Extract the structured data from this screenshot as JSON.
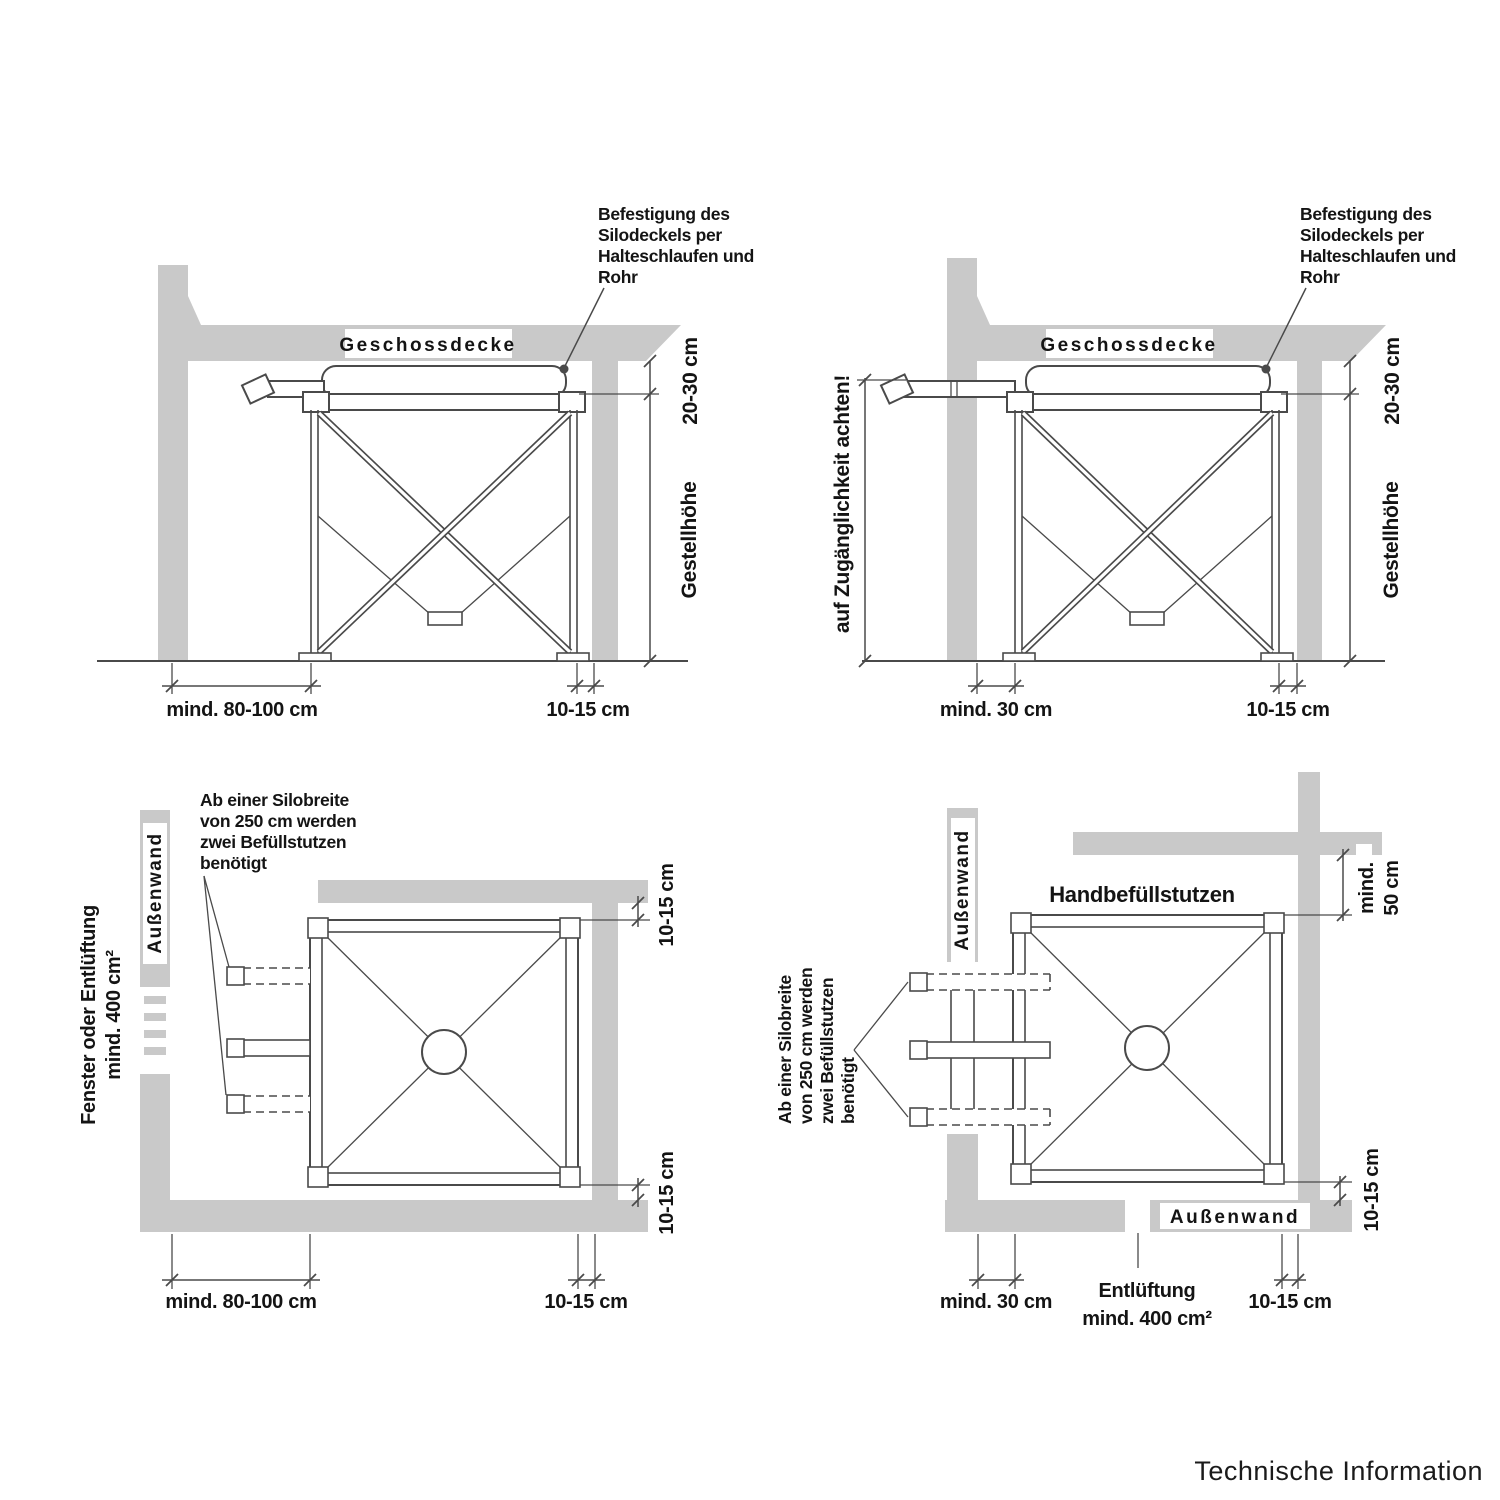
{
  "colors": {
    "background": "#ffffff",
    "wall_gray": "#c9c9c9",
    "line": "#4a4a4a",
    "text": "#141414"
  },
  "panels": {
    "top_left": {
      "wall_label": "Geschossdecke",
      "note": [
        "Befestigung des",
        "Silodeckels per",
        "Halteschlaufen und",
        "Rohr"
      ],
      "dim_gap_top": "20-30 cm",
      "dim_height": "Gestellhöhe",
      "dim_left": "mind. 80-100 cm",
      "dim_right": "10-15 cm"
    },
    "top_right": {
      "wall_label": "Geschossdecke",
      "note": [
        "Befestigung des",
        "Silodeckels per",
        "Halteschlaufen und",
        "Rohr"
      ],
      "note_left": "auf Zugänglichkeit achten!",
      "dim_gap_top": "20-30 cm",
      "dim_height": "Gestellhöhe",
      "dim_left": "mind. 30 cm",
      "dim_right": "10-15 cm"
    },
    "bottom_left": {
      "window_note": [
        "Fenster oder Entlüftung",
        "mind. 400 cm²"
      ],
      "wall_label": "Außenwand",
      "stub_note": [
        "Ab einer Silobreite",
        "von 250 cm werden",
        "zwei Befüllstutzen",
        "benötigt"
      ],
      "dim_top_right": "10-15 cm",
      "dim_side_right": "10-15 cm",
      "dim_left": "mind. 80-100 cm",
      "dim_right": "10-15 cm"
    },
    "bottom_right": {
      "wall_label_left": "Außenwand",
      "wall_label_bottom": "Außenwand",
      "title": "Handbefüllstutzen",
      "stub_note": [
        "Ab einer Silobreite",
        "von 250 cm werden",
        "zwei Befüllstutzen",
        "benötigt"
      ],
      "dim_wall_top": [
        "mind.",
        "50 cm"
      ],
      "dim_side_right": "10-15 cm",
      "dim_left": "mind. 30 cm",
      "vent_note": [
        "Entlüftung",
        "mind. 400 cm²"
      ],
      "dim_right": "10-15 cm"
    }
  },
  "footer": "Technische Information"
}
